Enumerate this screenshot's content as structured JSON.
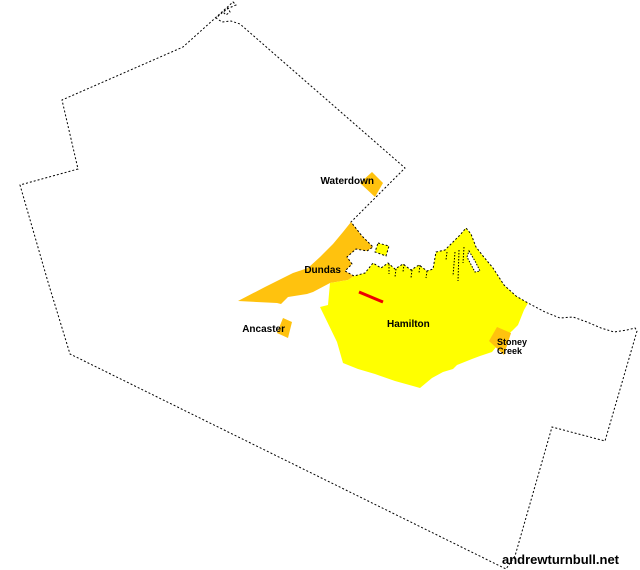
{
  "canvas": {
    "width": 640,
    "height": 570,
    "background": "#ffffff"
  },
  "palette": {
    "town_orange": "#ffc20e",
    "city_yellow": "#ffff00",
    "highlight_red": "#ee0000",
    "border_black": "#000000",
    "water_white": "#ffffff",
    "label_color": "#000000"
  },
  "watermark": {
    "text": "andrewturnbull.net"
  },
  "border": {
    "dash": "2 2",
    "stroke_width": 1,
    "points": "233,2 236,5 229,8 223,12 226,15 230,12 228,8 223,12 216,18 222,22 231,21 240,24 405,168 351,222 362,236 373,247 367,251 356,249 347,257 352,264 345,271 354,276 365,273 373,263 381,268 388,263 395,269 403,264 411,270 419,265 427,271 433,269 436,252 445,250 453,242 460,235 466,228 471,234 476,247 483,256 493,268 504,285 516,296 528,303 545,312 560,318 573,317 587,322 601,328 614,332 627,330 635,328 637,331 605,441 552,427 515,556 506,569 70,354 48,282 20,185 78,169 62,100 183,47"
  },
  "regions": [
    {
      "id": "dundas-urban-area",
      "fill": "#ffc20e",
      "points": "351,222 362,236 373,247 367,251 356,249 347,257 352,264 345,271 354,276 348,280 330,283 313,292 307,294 288,297 281,304 277,303 238,301 265,287 293,273 308,268 320,257 333,244 343,232"
    },
    {
      "id": "hamilton-urban-area",
      "fill": "#ffff00",
      "points": "354,276 365,273 373,263 381,268 388,263 395,269 403,264 411,270 419,265 427,271 433,269 436,252 445,250 453,242 460,235 466,228 471,234 476,247 483,256 493,268 504,285 516,296 528,303 524,310 518,325 512,331 505,337 497,346 492,352 480,356 472,359 457,365 453,369 443,372 432,378 420,388 413,386 395,381 375,374 358,369 343,363 337,342 320,307 328,305 330,283 348,280"
    },
    {
      "id": "desjardins-pond",
      "fill": "#ffff00",
      "dash": "2 2",
      "stroke": "#000000",
      "points": "378,243 389,246 386,256 375,252"
    },
    {
      "id": "beach-canal",
      "fill": "#ffffff",
      "dash": "1.5 1.5",
      "stroke": "#000000",
      "points": "469,251 475,261 480,271 475,272 467,257"
    },
    {
      "id": "waterdown-urban-area",
      "fill": "#ffc20e",
      "points": "372,172 383,183 375,197 360,183"
    },
    {
      "id": "ancaster-urban-area",
      "fill": "#ffc20e",
      "points": "283,318 292,322 288,338 277,333"
    },
    {
      "id": "stoney-creek-urban-area",
      "fill": "#ffc20e",
      "points": "497,327 511,333 504,355 489,341"
    }
  ],
  "piers": {
    "dash": "1.5 1.5",
    "segments": [
      [
        389,
        264,
        389,
        274
      ],
      [
        396,
        269,
        395,
        277
      ],
      [
        404,
        264,
        403,
        272
      ],
      [
        412,
        270,
        411,
        278
      ],
      [
        420,
        265,
        419,
        273
      ],
      [
        427,
        271,
        426,
        278
      ],
      [
        447,
        252,
        446,
        260
      ],
      [
        455,
        252,
        453,
        276
      ],
      [
        459,
        250,
        458,
        281
      ],
      [
        464,
        247,
        463,
        263
      ]
    ]
  },
  "highlight_line": {
    "id": "highlight-red-line",
    "x1": 359,
    "y1": 292,
    "x2": 383,
    "y2": 302,
    "width": 3,
    "color": "#ee0000"
  },
  "labels": [
    {
      "id": "waterdown-label",
      "text": "Waterdown",
      "x": 374,
      "y": 184,
      "anchor": "end",
      "size": 10
    },
    {
      "id": "dundas-label",
      "text": "Dundas",
      "x": 341,
      "y": 273,
      "anchor": "end",
      "size": 10
    },
    {
      "id": "ancaster-label",
      "text": "Ancaster",
      "x": 285,
      "y": 332,
      "anchor": "end",
      "size": 10
    },
    {
      "id": "hamilton-label",
      "text": "Hamilton",
      "x": 387,
      "y": 327,
      "anchor": "start",
      "size": 10
    },
    {
      "id": "stoney-creek-label-line1",
      "text": "Stoney",
      "x": 497,
      "y": 345,
      "anchor": "start",
      "size": 9
    },
    {
      "id": "stoney-creek-label-line2",
      "text": "Creek",
      "x": 497,
      "y": 354,
      "anchor": "start",
      "size": 9
    }
  ]
}
